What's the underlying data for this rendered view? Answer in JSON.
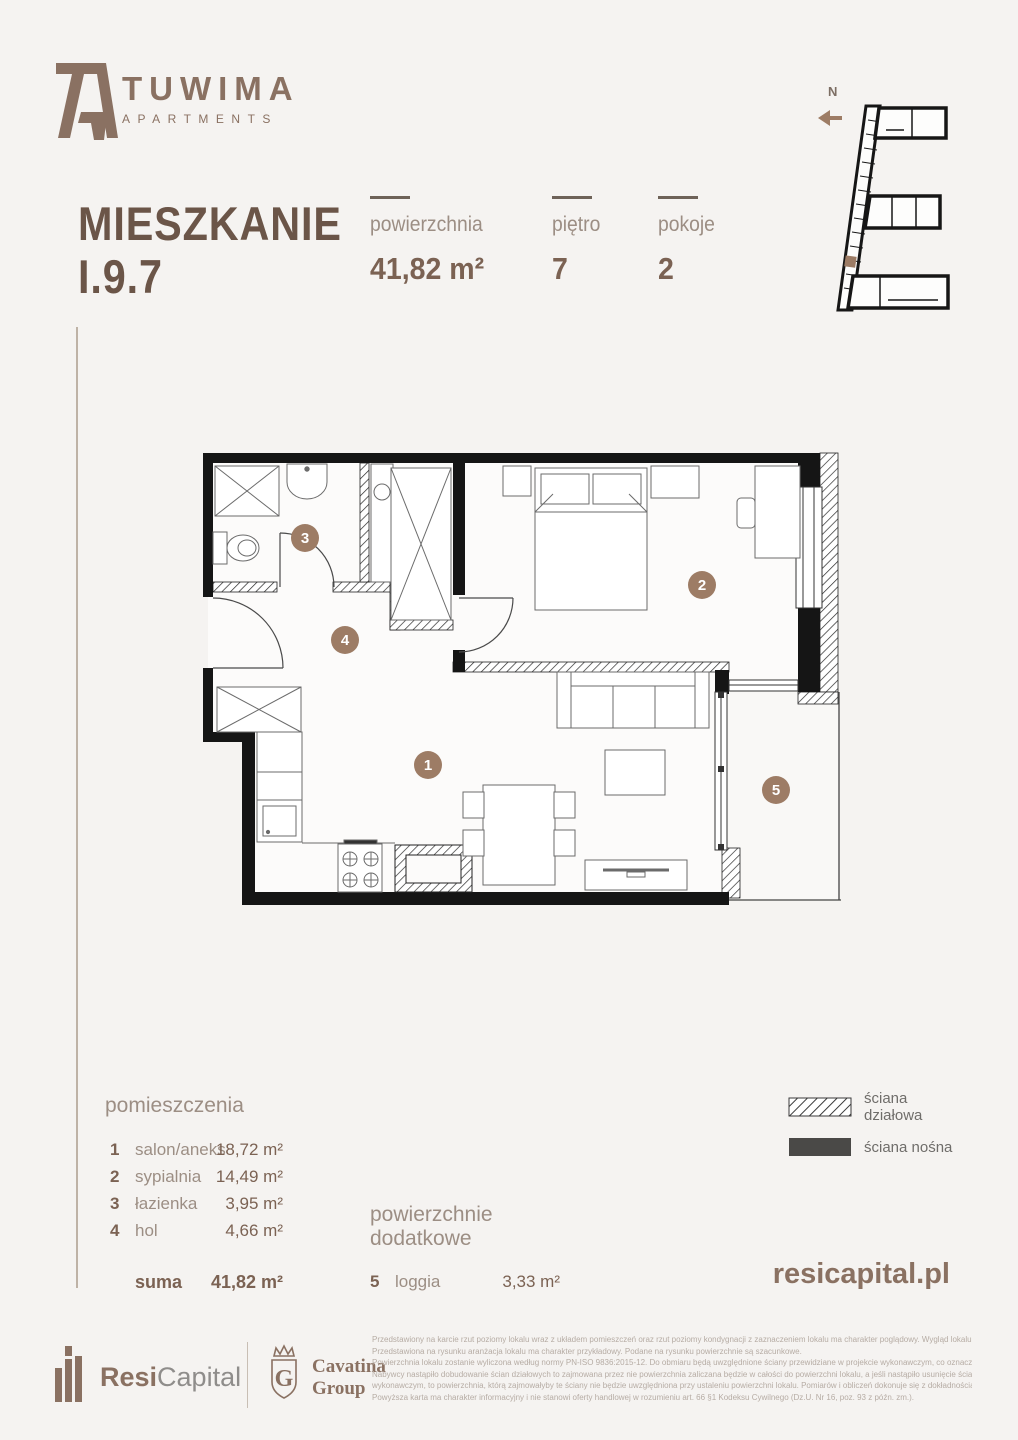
{
  "brand": {
    "name": "TUWIMA",
    "subtitle": "APARTMENTS"
  },
  "header": {
    "title_line1": "MIESZKANIE",
    "title_line2": "I.9.7"
  },
  "stats": [
    {
      "label": "powierzchnia",
      "value": "41,82 m²"
    },
    {
      "label": "piętro",
      "value": "7"
    },
    {
      "label": "pokoje",
      "value": "2"
    }
  ],
  "compass": {
    "north": "N"
  },
  "plan": {
    "labels": [
      "1",
      "2",
      "3",
      "4",
      "5"
    ]
  },
  "rooms": {
    "header": "pomieszczenia",
    "items": [
      {
        "no": "1",
        "name": "salon/aneks",
        "area": "18,72 m²"
      },
      {
        "no": "2",
        "name": "sypialnia",
        "area": "14,49 m²"
      },
      {
        "no": "3",
        "name": "łazienka",
        "area": "3,95 m²"
      },
      {
        "no": "4",
        "name": "hol",
        "area": "4,66 m²"
      }
    ],
    "sum_label": "suma",
    "sum_value": "41,82 m²"
  },
  "additional": {
    "header_line1": "powierzchnie",
    "header_line2": "dodatkowe",
    "item": {
      "no": "5",
      "name": "loggia",
      "area": "3,33 m²"
    }
  },
  "legend": {
    "partition_label": "ściana działowa",
    "bearing_label": "ściana nośna"
  },
  "website": "resicapital.pl",
  "footer": {
    "resi": "Resi",
    "capital": "Capital",
    "cavatina_line1": "Cavatina",
    "cavatina_line2": "Group",
    "disclaimer_lines": [
      "Przedstawiony na karcie rzut poziomy lokalu wraz z układem pomieszczeń oraz rzut poziomy kondygnacji z zaznaczeniem lokalu ma charakter poglądowy. Wygląd lokalu może nieznacznie ulec zmianie.",
      "Przedstawiona na rysunku aranżacja lokalu ma charakter przykładowy. Podane na rysunku powierzchnie są szacunkowe.",
      "Powierzchnia lokalu zostanie wyliczona według normy PN-ISO 9836:2015-12. Do obmiaru będą uwzględnione ściany przewidziane w projekcie wykonawczym, co oznacza, że jeżeli na życzenie",
      "Nabywcy nastąpiło dobudowanie ścian działowych to zajmowana przez nie powierzchnia zaliczana będzie w całości do powierzchni lokalu, a jeśli nastąpiło usunięcie ścian przewidzianych w projekcie",
      "wykonawczym, to powierzchnia, którą zajmowałyby te ściany nie będzie uwzględniona przy ustaleniu powierzchni lokalu. Pomiarów i obliczeń dokonuje się z dokładnością do 0,01 m2.",
      "Powyższa karta ma charakter informacyjny i nie stanowi oferty handlowej w rozumieniu art. 66 §1 Kodeksu Cywilnego (Dz.U. Nr 16, poz. 93 z późn. zm.)."
    ]
  },
  "colors": {
    "background": "#f5f3f1",
    "brand_brown": "#8a7162",
    "title_brown": "#6b5548",
    "value_brown": "#7b6253",
    "label_gray": "#9c8e84",
    "room_badge": "#9d7c65",
    "bearing_wall": "#4a4947"
  }
}
